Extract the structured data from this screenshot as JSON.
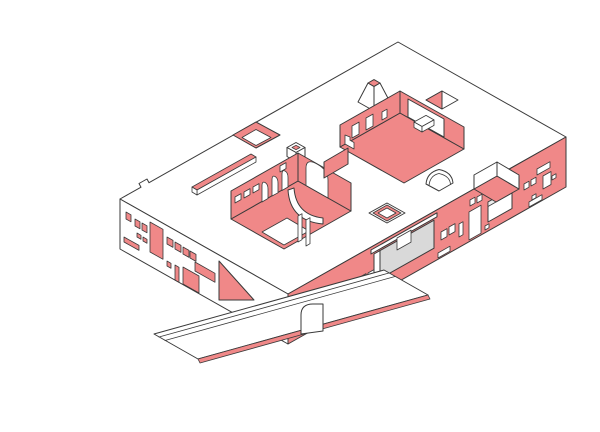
{
  "title": "Axonometric cutaway illustration of a long flat-roofed building with courtyards, skylights and an access ramp",
  "colors": {
    "background": "#ffffff",
    "accent": "#f08888",
    "outline": "#3a3a3a",
    "recess_gray": "#d9d9d9",
    "light_gray": "#ececec"
  },
  "scene": {
    "description": "White isometric roof slab seen from the south-west. The left (west) facade is white with red window openings; the long front (south-east) facade is red with white window openings, a grey recessed entrance and a white canopy. The roof is pierced by a skylight well, a linear ridge skylight, a small cube, a truncated-pyramid skylight, a triangular opening, a barrel-vault skylight, a square tray skylight, a sunken terrace and two courtyards: one with a red floor, wall openings and a bench, one lined with red walls, square windows, arched openings and a curved wall. A long white ramp with a red edge and a round-cornered parapet wall descends to the lower left.",
    "parts": [
      "roof-slab",
      "west-facade",
      "west-facade-windows",
      "ramp-cut-wall",
      "south-facade",
      "south-facade-windows",
      "entrance-recess",
      "entrance-window",
      "entrance-canopy",
      "facade-picture-window",
      "roof-terrace",
      "access-ramp",
      "ramp-curb-lines",
      "ramp-red-edge",
      "curved-parapet-wall",
      "skylight-well",
      "linear-skylight",
      "roof-cube",
      "pyramid-skylight",
      "triangle-skylight",
      "upper-courtyard",
      "courtyard-bench",
      "courtyard-stair",
      "arched-courtyard",
      "arch-openings",
      "curved-courtyard-wall",
      "courtyard-door-slits",
      "vault-skylight",
      "tray-skylight"
    ]
  }
}
